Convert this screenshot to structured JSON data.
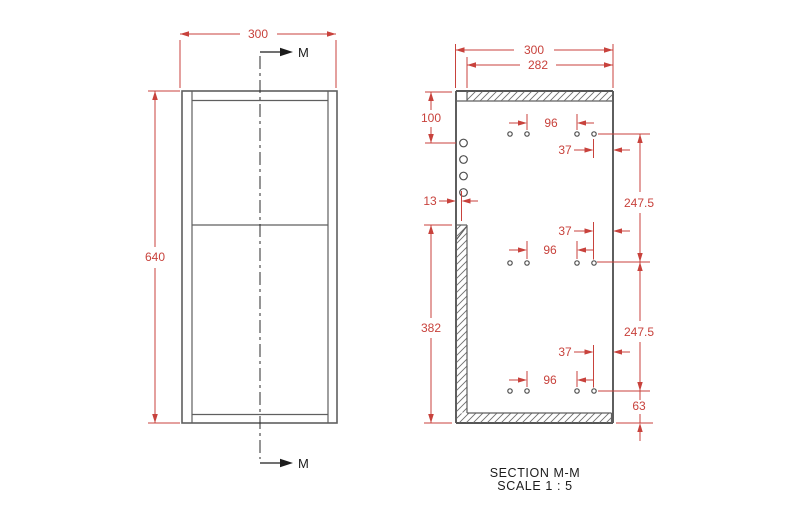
{
  "front_view": {
    "width_label": "300",
    "height_label": "640",
    "section_letter": "M"
  },
  "section_view": {
    "overall_width": "300",
    "opening_width": "282",
    "top_hole_offset": "100",
    "back_panel_thickness": "13",
    "side_panel_length": "382",
    "hole_pair_spacing": "96",
    "front_edge_offset": "37",
    "row_spacing": "247.5",
    "bottom_hole_offset": "63",
    "caption_title": "SECTION M-M",
    "caption_scale": "SCALE 1 : 5"
  },
  "colors": {
    "dimension_red": "#c8423c",
    "geometry_gray": "#5f5f5f",
    "annotation_black": "#1c1c1c",
    "background": "#ffffff"
  }
}
